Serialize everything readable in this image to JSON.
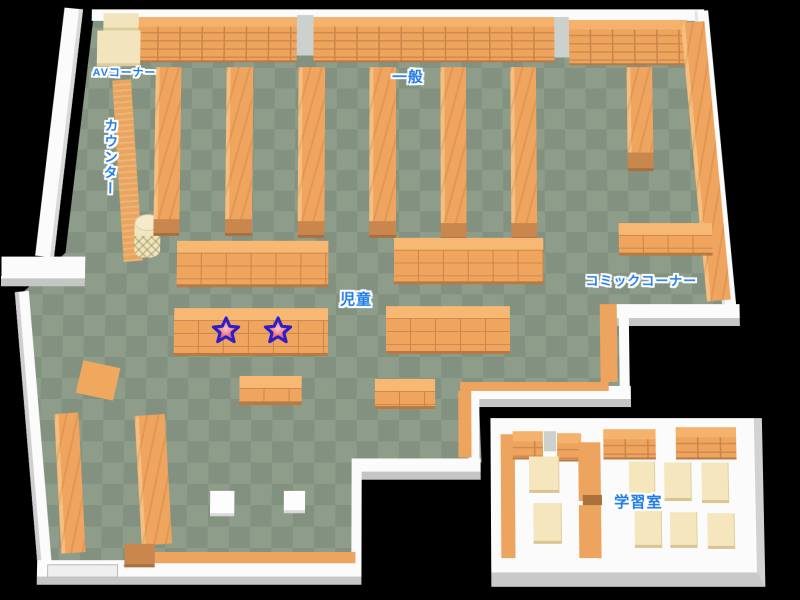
{
  "map": {
    "kind": "library-floor-map",
    "areas": {
      "av_corner": {
        "label": "AVコーナー"
      },
      "general": {
        "label": "一般"
      },
      "counter": {
        "label": "カウンター"
      },
      "children": {
        "label": "児童"
      },
      "comic_corner": {
        "label": "コミックコーナー"
      },
      "study_room": {
        "label": "学習室"
      }
    },
    "markers": {
      "type": "star",
      "count": 2,
      "location_area": "児童"
    },
    "palette": {
      "background": "#000000",
      "floor_light": "#8e9d8a",
      "floor_dark": "#839180",
      "shelf_orange": "#efa55f",
      "shelf_line": "#c8854a",
      "shelf_endcap": "#c9874d",
      "wall_white": "#fbfbfb",
      "wall_gray": "#c6c6c6",
      "counter_cream": "#f2e5be",
      "table_cream": "#f5e6bd",
      "label_blue": "#1e7ce8",
      "label_outline": "#ffffff",
      "star_fill": "#ee6a74",
      "star_outline": "#2b1ec8"
    }
  }
}
